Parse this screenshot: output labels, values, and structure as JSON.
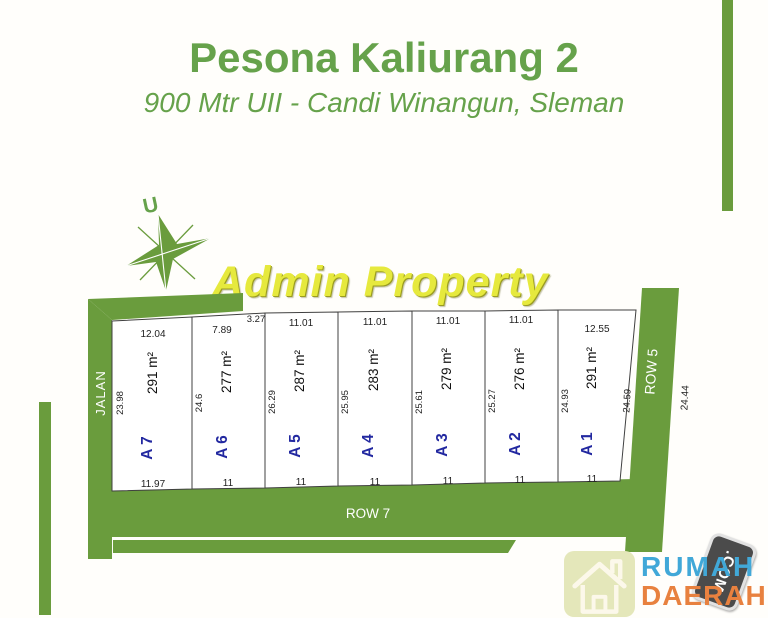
{
  "header": {
    "title": "Pesona Kaliurang 2",
    "subtitle": "900 Mtr UII - Candi Winangun, Sleman"
  },
  "watermark": "Admin Property",
  "compass": {
    "north_label": "U"
  },
  "plan": {
    "road_left_label": "JALAN",
    "road_bottom_label": "ROW 7",
    "road_right_label": "ROW 5",
    "road_right_outer_dim": "24.44",
    "plots": [
      {
        "id": "A 7",
        "area": "291 m²",
        "top": "12.04",
        "left": "23.98",
        "bottom": "11.97"
      },
      {
        "id": "A 6",
        "area": "277 m²",
        "top": "7.89",
        "top2": "3.27",
        "left": "24.6",
        "bottom": "11"
      },
      {
        "id": "A 5",
        "area": "287 m²",
        "top": "11.01",
        "left": "26.29",
        "bottom": "11"
      },
      {
        "id": "A 4",
        "area": "283 m²",
        "top": "11.01",
        "left": "25.95",
        "bottom": "11"
      },
      {
        "id": "A 3",
        "area": "279 m²",
        "top": "11.01",
        "left": "25.61",
        "bottom": "11"
      },
      {
        "id": "A 2",
        "area": "276 m²",
        "top": "11.01",
        "left": "25.27",
        "bottom": "11"
      },
      {
        "id": "A 1",
        "area": "291 m²",
        "top": "12.55",
        "left": "24.93",
        "right": "24.59",
        "bottom": "11"
      }
    ]
  },
  "logo": {
    "word1": "RUMAH",
    "word2": "DAERAH",
    "tag": ".COM"
  },
  "colors": {
    "title_green": "#66a24b",
    "road_green": "#6a9c3d",
    "watermark_yellow": "#e6e93d",
    "plot_id_blue": "#2228a0",
    "logo_blue": "#41a8d8",
    "logo_orange": "#e8813f",
    "tag_gray": "#4b4b4b"
  }
}
